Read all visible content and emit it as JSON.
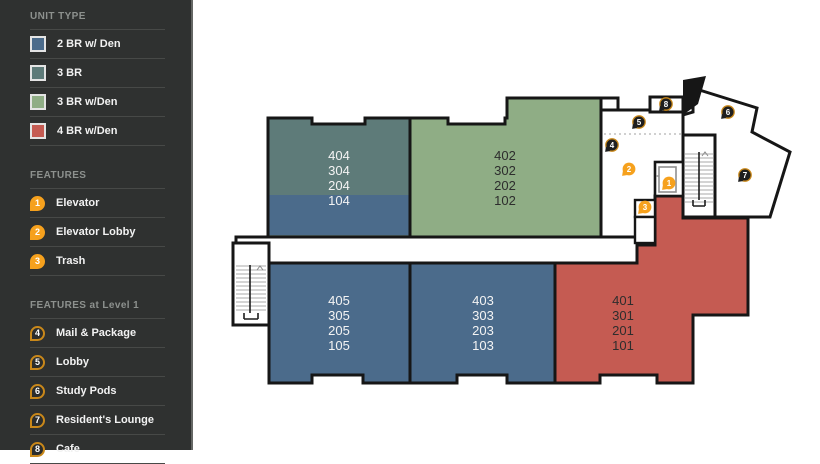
{
  "sidebar": {
    "sections": [
      {
        "title": "UNIT TYPE",
        "items": [
          {
            "label": "2 BR w/ Den",
            "color": "#4b6b8b"
          },
          {
            "label": "3 BR",
            "color": "#5e7b79"
          },
          {
            "label": "3 BR w/Den",
            "color": "#8fad85"
          },
          {
            "label": "4 BR w/Den",
            "color": "#c55b52"
          }
        ]
      },
      {
        "title": "FEATURES",
        "items": [
          {
            "num": "1",
            "label": "Elevator"
          },
          {
            "num": "2",
            "label": "Elevator Lobby"
          },
          {
            "num": "3",
            "label": "Trash"
          }
        ]
      },
      {
        "title": "FEATURES at Level 1",
        "items": [
          {
            "num": "4",
            "label": "Mail & Package"
          },
          {
            "num": "5",
            "label": "Lobby"
          },
          {
            "num": "6",
            "label": "Study Pods"
          },
          {
            "num": "7",
            "label": "Resident's Lounge"
          },
          {
            "num": "8",
            "label": "Cafe"
          }
        ]
      }
    ]
  },
  "plan": {
    "units": [
      {
        "id": "stack-404",
        "stack": [
          "404",
          "304",
          "204",
          "104"
        ],
        "type_upper": "3 BR",
        "type_level1": "2 BR w/ Den"
      },
      {
        "id": "stack-402",
        "stack": [
          "402",
          "302",
          "202",
          "102"
        ],
        "type_upper": "3 BR w/Den",
        "type_level1": "3 BR w/Den"
      },
      {
        "id": "stack-405",
        "stack": [
          "405",
          "305",
          "205",
          "105"
        ],
        "type_upper": "2 BR w/ Den",
        "type_level1": "2 BR w/ Den"
      },
      {
        "id": "stack-403",
        "stack": [
          "403",
          "303",
          "203",
          "103"
        ],
        "type_upper": "2 BR w/ Den",
        "type_level1": "2 BR w/ Den"
      },
      {
        "id": "stack-401",
        "stack": [
          "401",
          "301",
          "201",
          "101"
        ],
        "type_upper": "4 BR w/Den",
        "type_level1": "4 BR w/Den"
      }
    ],
    "markers": [
      {
        "num": "1",
        "label": "Elevator",
        "style": "solid"
      },
      {
        "num": "2",
        "label": "Elevator Lobby",
        "style": "solid"
      },
      {
        "num": "3",
        "label": "Trash",
        "style": "solid"
      },
      {
        "num": "4",
        "label": "Mail & Package",
        "style": "outline"
      },
      {
        "num": "5",
        "label": "Lobby",
        "style": "outline"
      },
      {
        "num": "6",
        "label": "Study Pods",
        "style": "outline"
      },
      {
        "num": "7",
        "label": "Resident's Lounge",
        "style": "outline"
      },
      {
        "num": "8",
        "label": "Cafe",
        "style": "outline"
      }
    ]
  },
  "colors": {
    "sidebar_bg": "#2f3130",
    "sidebar_header": "#8d918e",
    "accent_orange": "#f6a11d",
    "pin_ring": "#c9881a",
    "wall": "#161616",
    "unit_blue": "#4b6b8b",
    "unit_teal": "#5e7b79",
    "unit_green": "#8fad85",
    "unit_red": "#c55b52"
  }
}
